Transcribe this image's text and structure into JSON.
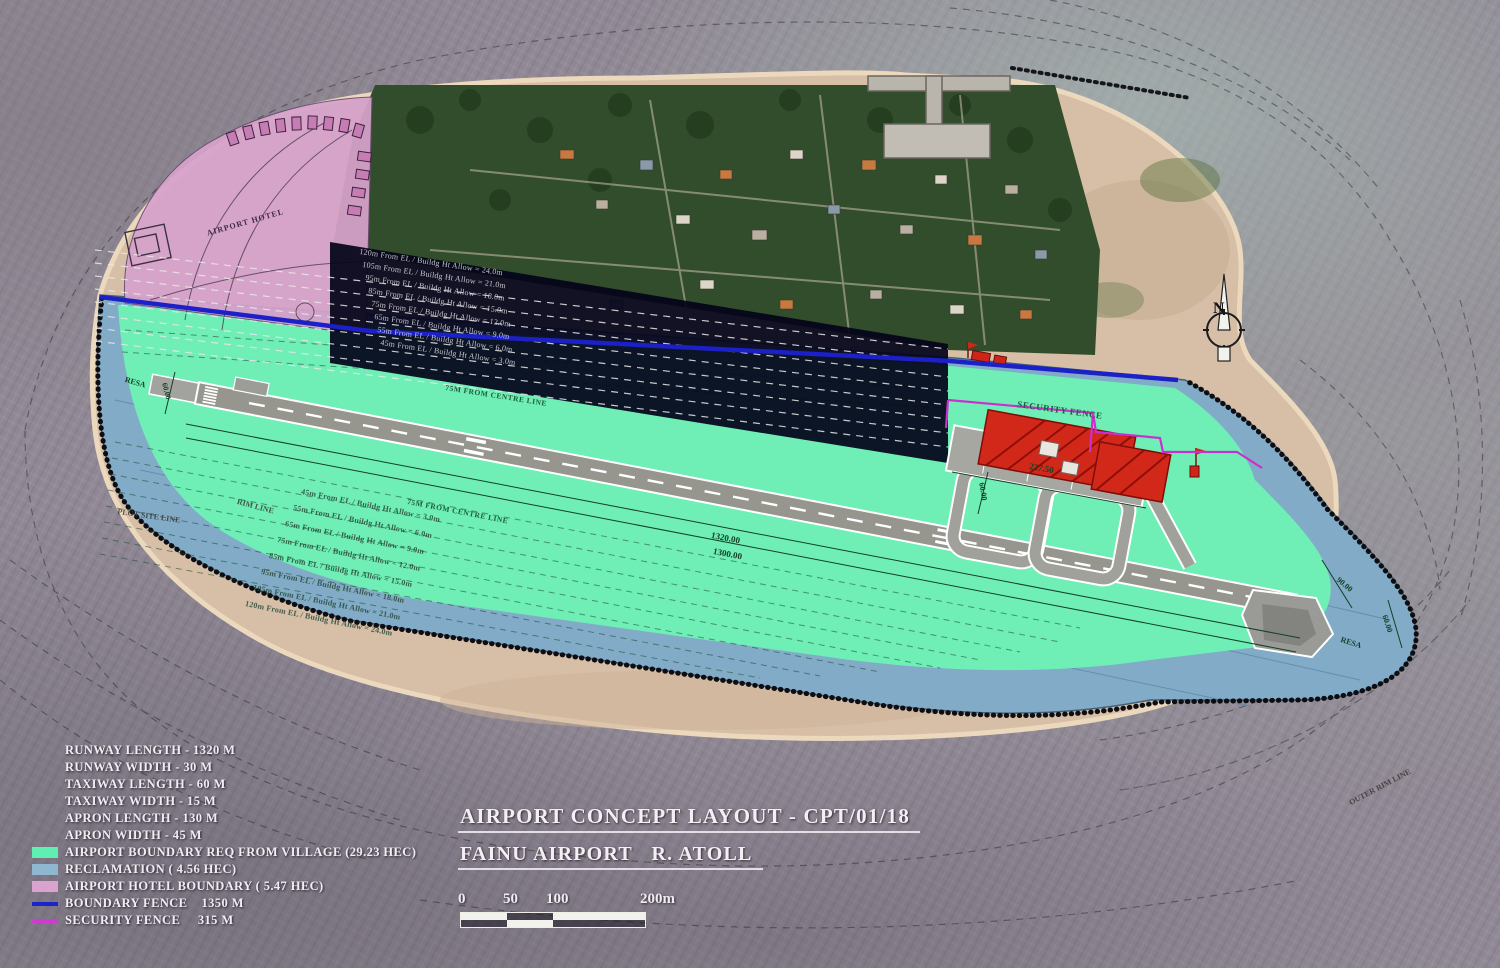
{
  "title": {
    "line1": "AIRPORT CONCEPT LAYOUT - CPT/01/18",
    "line2": "FAINU AIRPORT   R. ATOLL"
  },
  "scale_bar": {
    "ticks": [
      "0",
      "50",
      "100",
      "200m"
    ]
  },
  "north": {
    "label": "N"
  },
  "legend": {
    "specs": [
      "RUNWAY LENGTH - 1320 M",
      "RUNWAY WIDTH - 30 M",
      "TAXIWAY LENGTH - 60 M",
      "TAXIWAY WIDTH - 15 M",
      "APRON LENGTH - 130 M",
      "APRON WIDTH - 45 M"
    ],
    "items": [
      {
        "label": "AIRPORT BOUNDARY REQ FROM VILLAGE (29.23 HEC)",
        "swatch": "#5fefb2",
        "type": "fill"
      },
      {
        "label": "RECLAMATION ( 4.56 HEC)",
        "swatch": "#8fb7cf",
        "type": "fill"
      },
      {
        "label": "AIRPORT HOTEL BOUNDARY ( 5.47 HEC)",
        "swatch": "#d9a2cf",
        "type": "fill"
      },
      {
        "label": "BOUNDARY FENCE    1350 M",
        "swatch": "#1d23cc",
        "type": "line"
      },
      {
        "label": "SECURITY FENCE     315  M",
        "swatch": "#cf3ad0",
        "type": "line"
      }
    ]
  },
  "map_labels": {
    "hotel": "AIRPORT HOTEL",
    "security_fence": "SECURITY FENCE",
    "centreline_upper": "75M FROM CENTRE LINE",
    "centreline_lower": "75M FROM CENTRE LINE",
    "dim_runway_1": "1320.00",
    "dim_runway_2": "1300.00",
    "dim_apron": "227.50",
    "dim_loop": "60.00",
    "resa_left": "RESA",
    "dim_left": "60.00",
    "dim_right_1": "90.00",
    "dim_right_2": "60.00",
    "resa_right": "RESA",
    "plot_site_line": "PLOT SITE LINE",
    "rim_line": "RIM LINE",
    "outer_rim_line": "OUTER RIM LINE"
  },
  "restrictions": {
    "upper": [
      "120m From EL / Buildg Ht Allow = 24.0m",
      "105m From EL / Buildg Ht Allow = 21.0m",
      "95m From EL / Buildg Ht Allow = 18.0m",
      "85m From EL / Buildg Ht Allow = 15.0m",
      "75m From EL / Buildg Ht Allow = 12.0m",
      "65m From EL / Buildg Ht Allow = 9.0m",
      "55m From EL / Buildg Ht Allow = 6.0m",
      "45m From EL / Buildg Ht Allow = 3.0m"
    ],
    "lower": [
      "45m From EL / Buildg Ht Allow = 3.0m",
      "55m From EL / Buildg Ht Allow = 6.0m",
      "65m From EL / Buildg Ht Allow = 9.0m",
      "75m From EL / Buildg Ht Allow = 12.0m",
      "85m From EL / Buildg Ht Allow = 15.0m",
      "95m From EL / Buildg Ht Allow = 18.0m",
      "105m From EL / Buildg Ht Allow = 21.0m",
      "120m From EL / Buildg Ht Allow = 24.0m"
    ]
  },
  "colors": {
    "airport_boundary_green": "#6ef0b5",
    "reclamation_blue": "#81abc6",
    "hotel_pink": "#d7a3cb",
    "boundary_fence_blue": "#1b20c7",
    "security_fence_magenta": "#cc2fcf",
    "runway_gray": "#96968f",
    "building_red": "#d2281a",
    "sand": "#d6bfa6",
    "village_overlay_navy": "#04041a"
  }
}
